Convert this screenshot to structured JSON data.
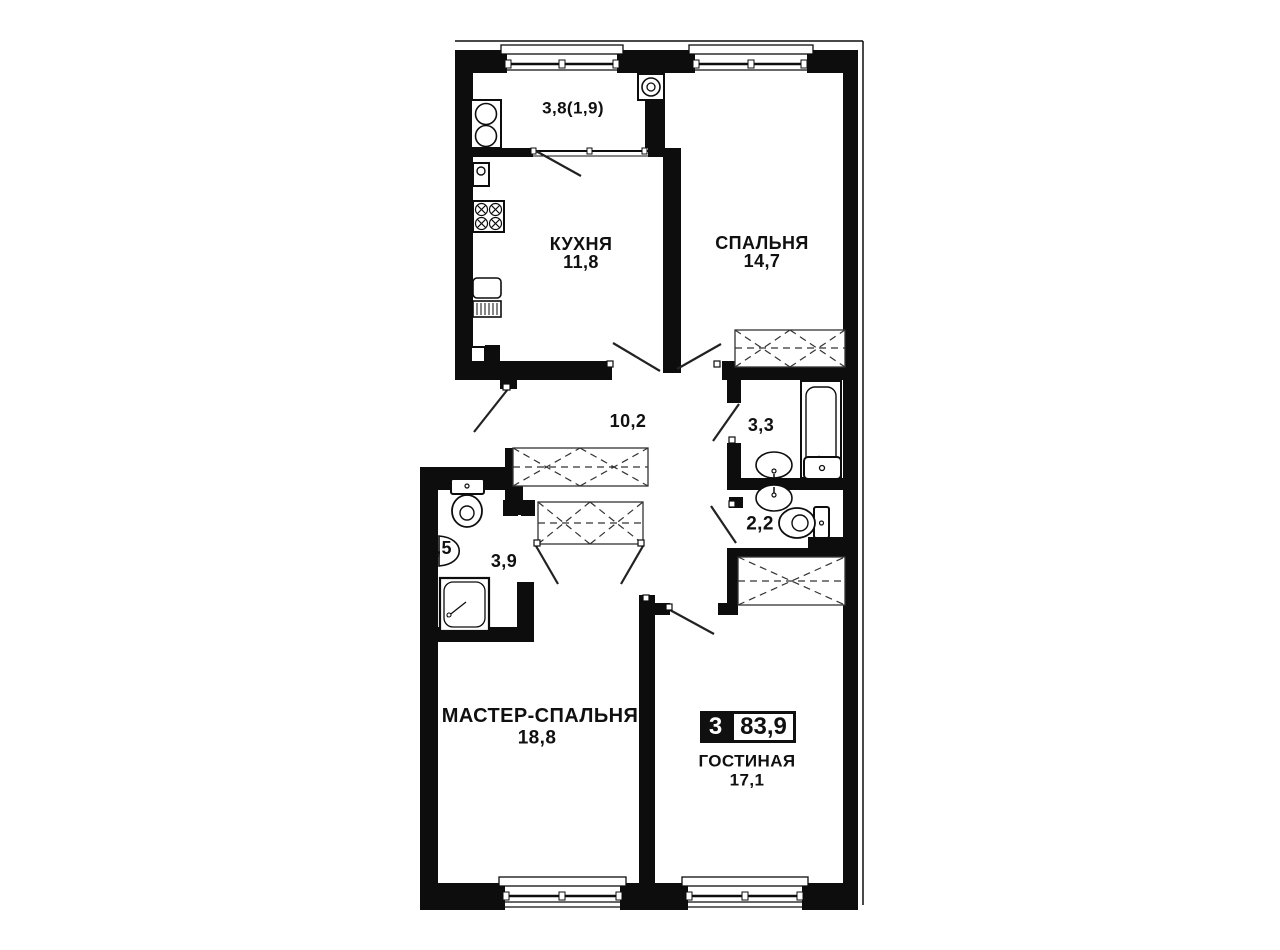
{
  "badge": {
    "room_count": "3",
    "total_area": "83,9"
  },
  "rooms": {
    "balcony": {
      "area": "3,8(1,9)"
    },
    "kitchen": {
      "name": "КУХНЯ",
      "area": "11,8"
    },
    "bedroom": {
      "name": "СПАЛЬНЯ",
      "area": "14,7"
    },
    "hallway": {
      "area": "10,2"
    },
    "bathroom": {
      "area": "3,3"
    },
    "wc": {
      "area": "2,2"
    },
    "shower_room": {
      "area": "3,9"
    },
    "niche": {
      "area": ",5"
    },
    "master_bedroom": {
      "name": "МАСТЕР-СПАЛЬНЯ",
      "area": "18,8"
    },
    "living_room": {
      "name": "ГОСТИНАЯ",
      "area": "17,1"
    }
  }
}
